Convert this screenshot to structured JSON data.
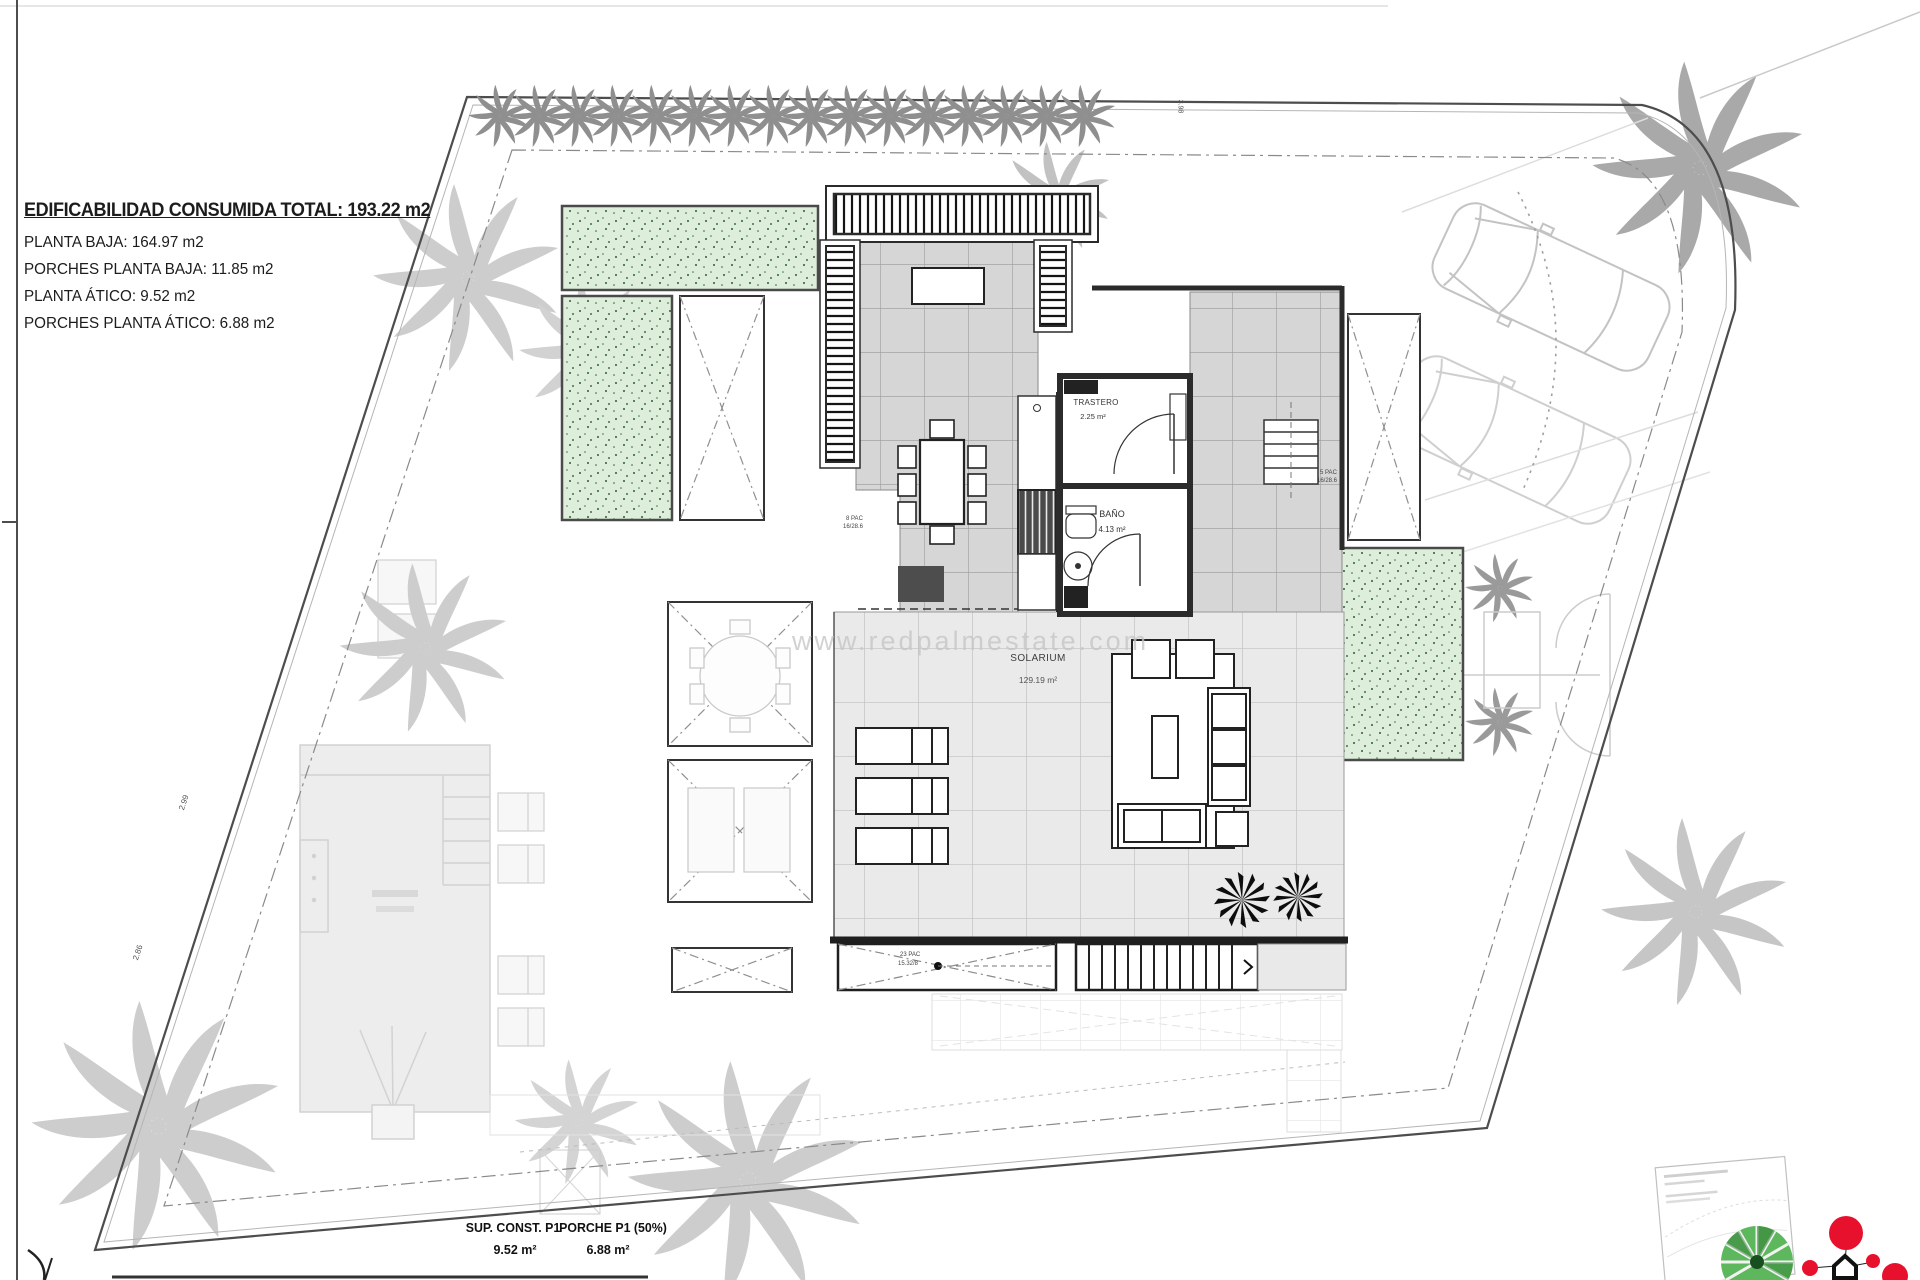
{
  "title_block": {
    "total_label": "EDIFICABILIDAD CONSUMIDA TOTAL: 193.22 m2",
    "lines": [
      "PLANTA BAJA: 164.97 m2",
      "PORCHES PLANTA BAJA: 11.85 m2",
      "PLANTA ÁTICO: 9.52 m2",
      "PORCHES PLANTA ÁTICO: 6.88 m2"
    ]
  },
  "rooms": {
    "trastero_name": "TRASTERO",
    "trastero_area": "2.25 m²",
    "bano_name": "BAÑO",
    "bano_area": "4.13 m²",
    "solarium_name": "SOLARIUM",
    "solarium_area": "129.19 m²"
  },
  "summary": {
    "col1_label": "SUP. CONST. P1",
    "col1_value": "9.52 m²",
    "col2_label": "PORCHE P1 (50%)",
    "col2_value": "6.88 m²"
  },
  "watermark": "www.redpalmestate.com",
  "tiny_labels": [
    "2.99",
    "2.86",
    "3.98",
    "8 PAC",
    "16/28.6",
    "5 PAC",
    "16/28.6",
    "23 PAC",
    "15.32/8"
  ],
  "colors": {
    "grass_fill": "#ddeeda",
    "wall": "#2b2b2b",
    "tile_terrace": "#d6d6d6",
    "tile_solarium": "#eaeaea",
    "ghost_gray": "#cfcfcf",
    "logo_red": "#e8112d",
    "logo_green": "#5db75d"
  },
  "icons": {
    "palm": "palm-icon",
    "plant": "plant-icon",
    "car": "car-icon",
    "logo_balloons": "logo-balloons-icon",
    "logo_palm_circle": "logo-palm-circle-icon"
  }
}
